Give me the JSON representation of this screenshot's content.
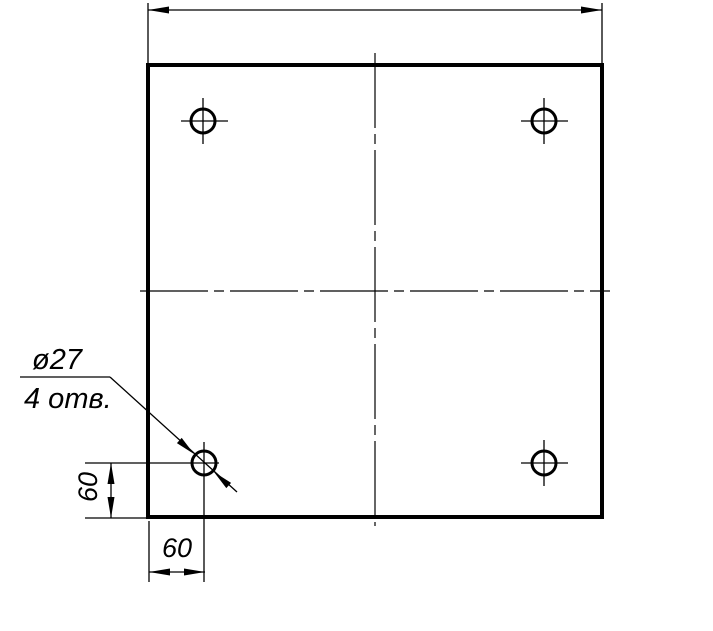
{
  "page": {
    "background_color": "#ffffff",
    "line_color": "#000000"
  },
  "drawing": {
    "type": "engineering-drawing",
    "subject": "square plate with four drilled holes, GOST-style dimensioning",
    "annotations": {
      "hole_diameter_label": "ø27",
      "hole_count_label": "4 отв.",
      "left_vertical_dim_label": "60",
      "bottom_horizontal_dim_label": "60"
    },
    "features": {
      "hole_count": 4,
      "hole_diameter_value": 27,
      "edge_offset_value": 60
    }
  }
}
